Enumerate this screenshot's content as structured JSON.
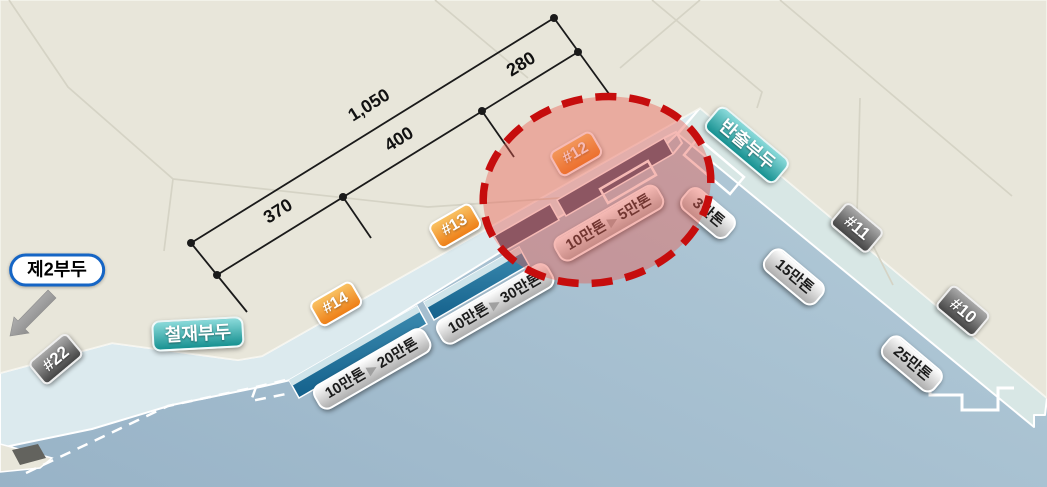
{
  "piers": {
    "pier2": "제2부두",
    "steel": "철재부두",
    "carryout": "반출부두"
  },
  "berth_tags": {
    "b10": "#10",
    "b11": "#11",
    "b12": "#12",
    "b13": "#13",
    "b14": "#14",
    "b22": "#22"
  },
  "dimensions": {
    "total": "1,050",
    "seg_370": "370",
    "seg_400": "400",
    "seg_280": "280"
  },
  "capacity_labels": {
    "berth14": {
      "from": "10만톤",
      "arrow": "▶",
      "to": "20만톤"
    },
    "berth13": {
      "from": "10만톤",
      "arrow": "▶",
      "to": "30만톤"
    },
    "berth12": {
      "from": "10만톤",
      "arrow": "▶",
      "to": "5만톤"
    }
  },
  "tonnage_labels": {
    "t3": "3만톤",
    "t15": "15만톤",
    "t25": "25만톤"
  },
  "colors": {
    "land": "#e8e6da",
    "water_deep": "#98b3c7",
    "water_light": "#b9d0dc",
    "quay": "#dceaee",
    "quay_right": "#d8e7e5",
    "berth_navy": "#4a5470",
    "berth_teal_dark": "#14618c",
    "berth_teal_light": "#3c8bb0",
    "highlight_red": "#c60d0d",
    "orange": "#ee7f17",
    "orange_light": "#f9c162",
    "teal_dark": "#179191",
    "teal_light": "#8adada",
    "gray_dark": "#454545",
    "gray_light": "#a9a9a9",
    "pill_light": "#ffffff",
    "pill_dark": "#aeaeae",
    "pier2_border": "#1565c5"
  }
}
